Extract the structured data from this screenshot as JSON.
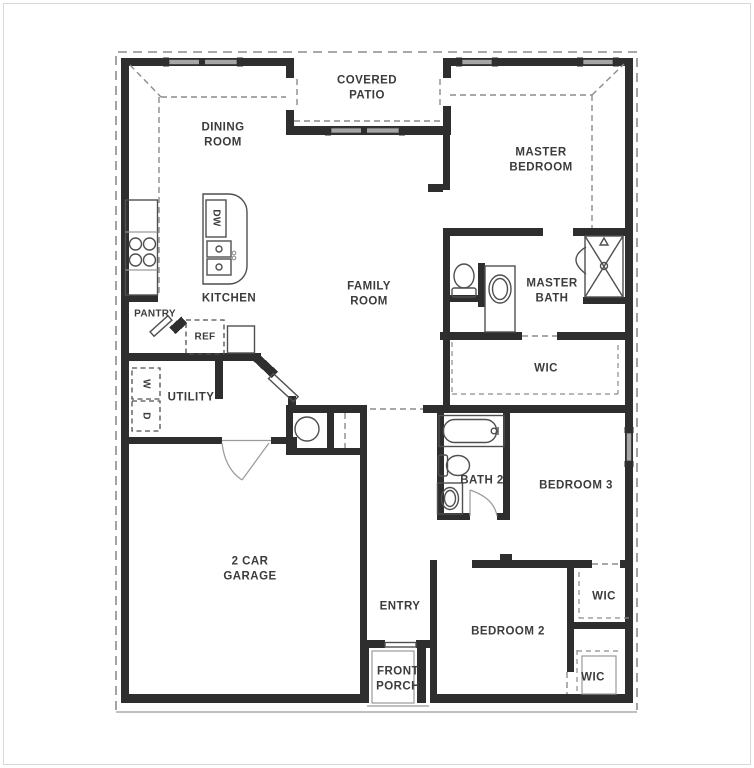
{
  "document": {
    "type": "floor-plan",
    "storeys": 1
  },
  "colors": {
    "wall": "#2e2e2e",
    "line": "#4f4f4f",
    "line_light": "#9a9a9a",
    "dash": "#8c8c8c",
    "window_fill": "#a6a6a6",
    "text": "#3c3c3c",
    "bg": "#ffffff",
    "frame": "#d8d8d8"
  },
  "labels": {
    "dining_room": "DINING\nROOM",
    "covered_patio": "COVERED\nPATIO",
    "master_bedroom": "MASTER\nBEDROOM",
    "kitchen": "KITCHEN",
    "pantry": "PANTRY",
    "ref": "REF",
    "dw": "DW",
    "family_room": "FAMILY\nROOM",
    "master_bath": "MASTER\nBATH",
    "wic_master": "WIC",
    "utility": "UTILITY",
    "washer": "W",
    "dryer": "D",
    "bath2": "BATH 2",
    "bedroom3": "BEDROOM 3",
    "garage": "2 CAR\nGARAGE",
    "entry": "ENTRY",
    "bedroom2": "BEDROOM 2",
    "wic_bedroom3": "WIC",
    "wic_bedroom2": "WIC",
    "front_porch": "FRONT\nPORCH"
  },
  "icons": {
    "cooktop": "4-burner-cooktop",
    "island_sink": "double-basin-sink",
    "dishwasher": "DW-cabinet",
    "refrigerator": "dashed-appliance-box",
    "washer": "dashed-appliance-box",
    "dryer": "dashed-appliance-box",
    "water_heater": "circle",
    "master_toilet": "toilet-top-view",
    "master_vanity": "oval-sink",
    "shower": "x-glass-shower",
    "tub": "bathtub-top-view",
    "bath2_toilet": "toilet-top-view",
    "bath2_vanity": "oval-sink",
    "windows": "gray-bar-with-end-caps",
    "roof_overhang": "dashed-outline"
  }
}
